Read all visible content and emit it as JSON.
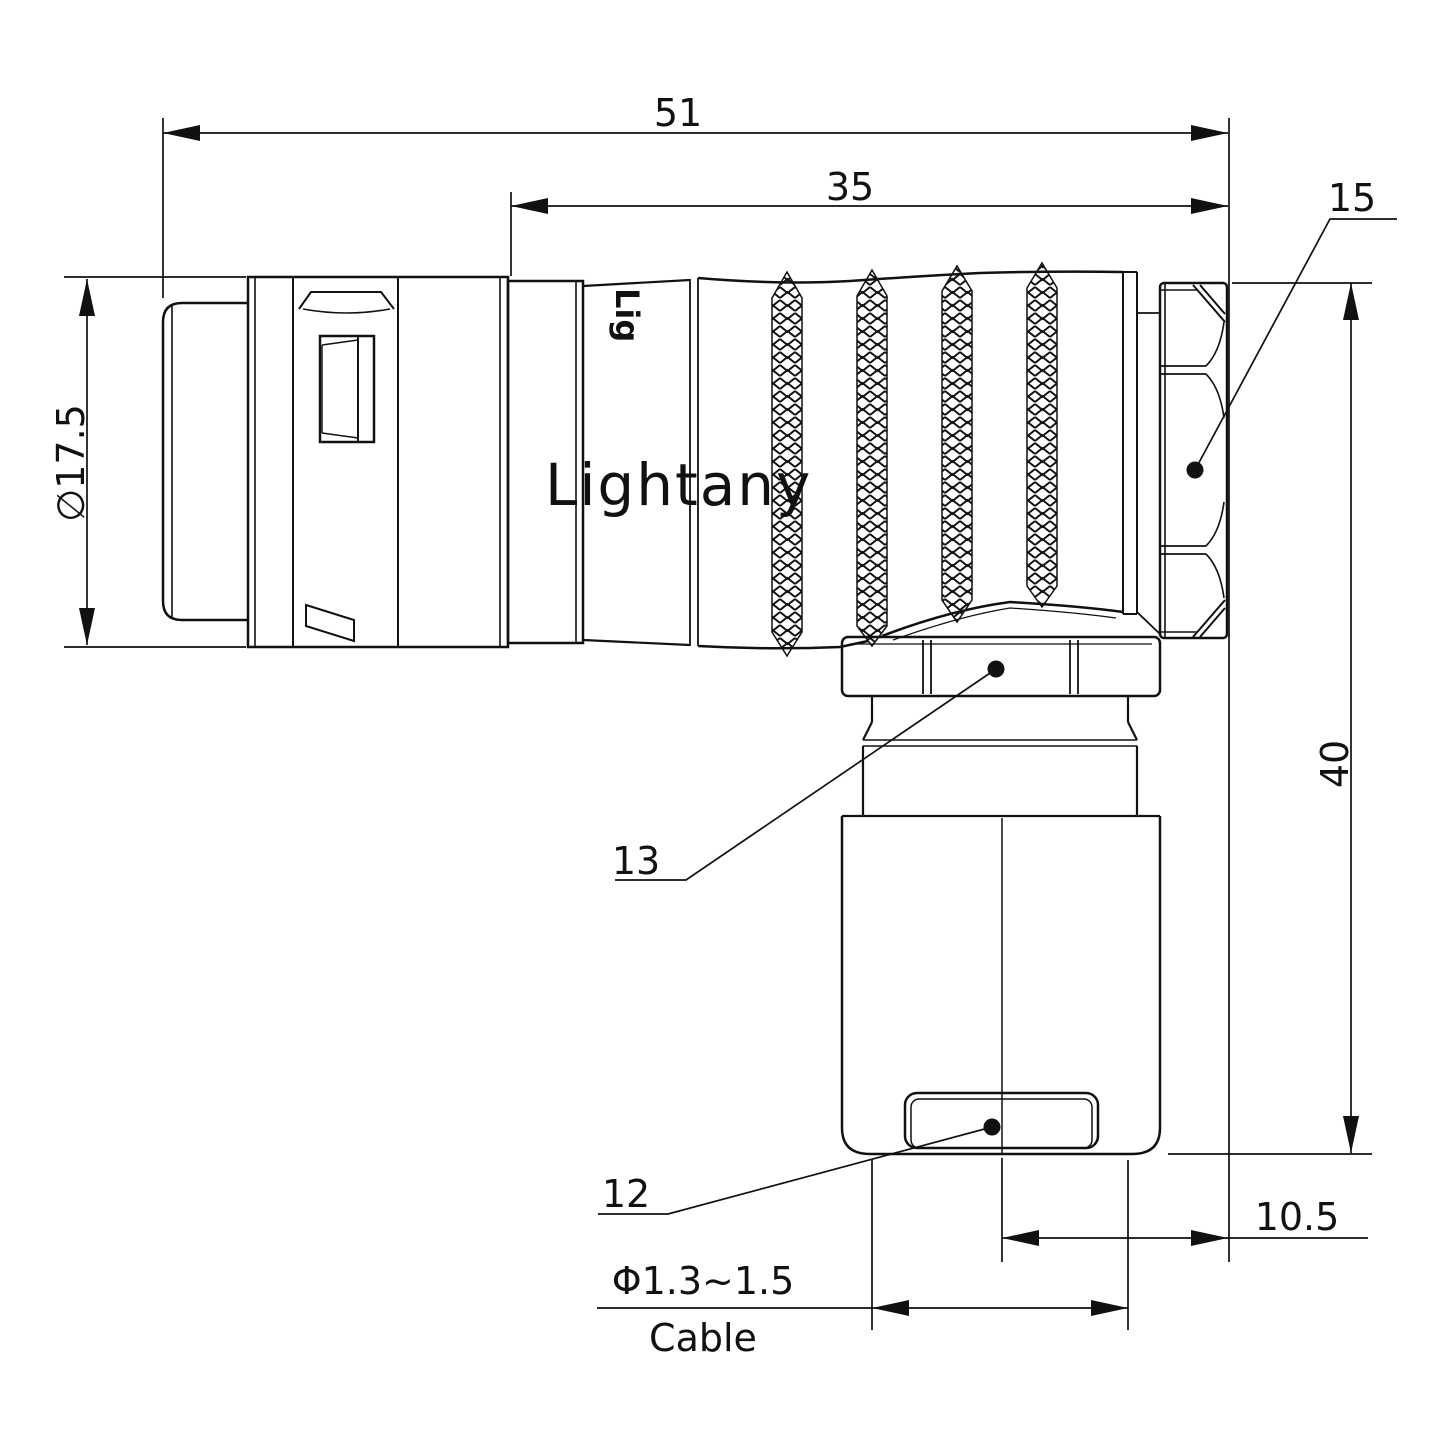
{
  "watermark": "Lightany",
  "body_marking": "Lig",
  "labels": {
    "dim_overall_length": "51",
    "dim_front_length": "35",
    "dim_shell_diameter": "∅17.5",
    "dim_height": "40",
    "dim_offset": "10.5",
    "callout_back_nut": "15",
    "callout_clamp_nut": "13",
    "callout_end_cap": "12",
    "dim_cable_diameter": "Φ1.3~1.5",
    "dim_cable_word": "Cable"
  },
  "colors": {
    "ink": "#111111",
    "watermark": "#eebcbc",
    "background": "#ffffff"
  }
}
